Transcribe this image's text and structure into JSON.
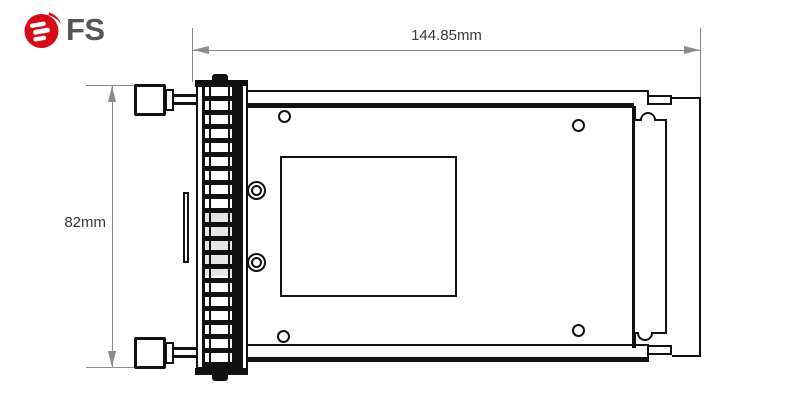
{
  "brand": {
    "logo_text": "FS",
    "logo_red": "#d70b16",
    "logo_gray": "#54565a"
  },
  "diagram": {
    "title": "Module top-view dimension drawing",
    "width_dimension": "144.85mm",
    "height_dimension": "82mm",
    "line_color": "#111111",
    "dimension_line_color": "#8a8a8a",
    "dimension_text_color": "#3a3a3a"
  }
}
